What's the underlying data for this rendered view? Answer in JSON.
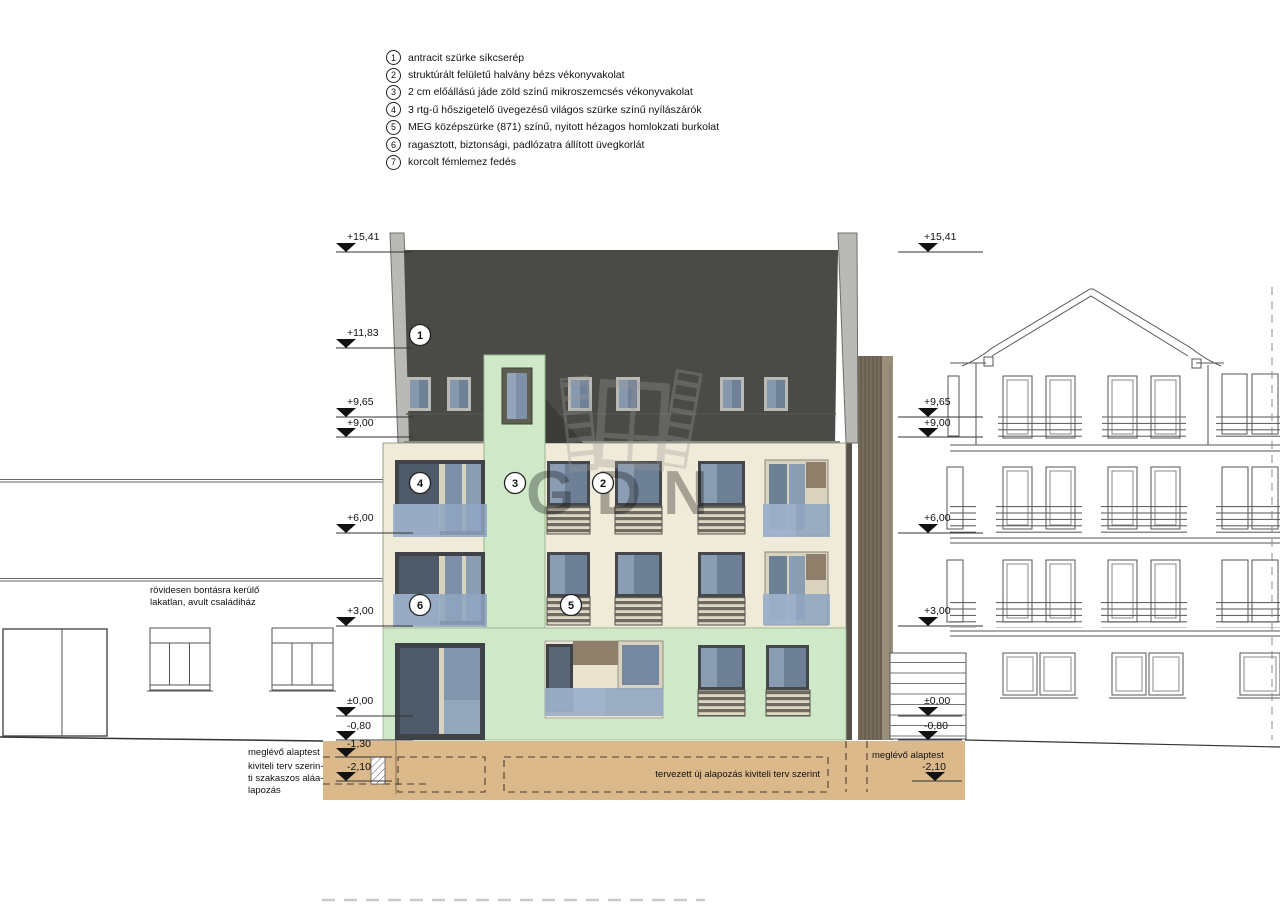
{
  "legend": {
    "items": [
      {
        "num": "1",
        "text": "antracit szürke síkcserép"
      },
      {
        "num": "2",
        "text": "struktúrált felületű halvány bézs vékonyvakolat"
      },
      {
        "num": "3",
        "text": "2 cm előállású jáde zöld színű mikroszemcsés vékonyvakolat"
      },
      {
        "num": "4",
        "text": "3 rtg-ű hőszigetelő üvegezésű világos szürke színű nyílászárók"
      },
      {
        "num": "5",
        "text": "MEG középszürke (871) színű, nyitott hézagos homlokzati burkolat"
      },
      {
        "num": "6",
        "text": "ragasztott, biztonsági, padlózatra állított üvegkorlát"
      },
      {
        "num": "7",
        "text": "korcolt fémlemez fedés"
      }
    ]
  },
  "markers": {
    "left": [
      "+15,41",
      "+11,83",
      "+9,65",
      "+9,00",
      "+6,00",
      "+3,00",
      "±0,00",
      "-0,80",
      "-1,30",
      "-2,10"
    ],
    "right": [
      "+15,41",
      "+9,65",
      "+9,00",
      "+6,00",
      "+3,00",
      "±0,00",
      "-0,80",
      "-2,10"
    ]
  },
  "callouts": [
    "1",
    "4",
    "3",
    "2",
    "6",
    "5"
  ],
  "labels": {
    "old_house_1": "rövidesen bontásra kerülő",
    "old_house_2": "lakatlan, avult családiház",
    "existing_foundation_left": "meglévő alaptest",
    "underpinning_1": "kiviteli terv szerin-",
    "underpinning_2": "ti szakaszos aláa-",
    "underpinning_3": "lapozás",
    "new_foundation": "tervezett új alapozás kiviteli terv szerint",
    "existing_foundation_right": "meglévő alaptest"
  },
  "watermark": {
    "text": "GDN"
  },
  "palette": {
    "roof": "#4a4a47",
    "facade": "#f0ebd8",
    "accent_green": "#cfe8c8",
    "glass": "#6d8095",
    "foundation_sand": "#dcb98b",
    "watermark_grey": "#9b9b9b"
  }
}
